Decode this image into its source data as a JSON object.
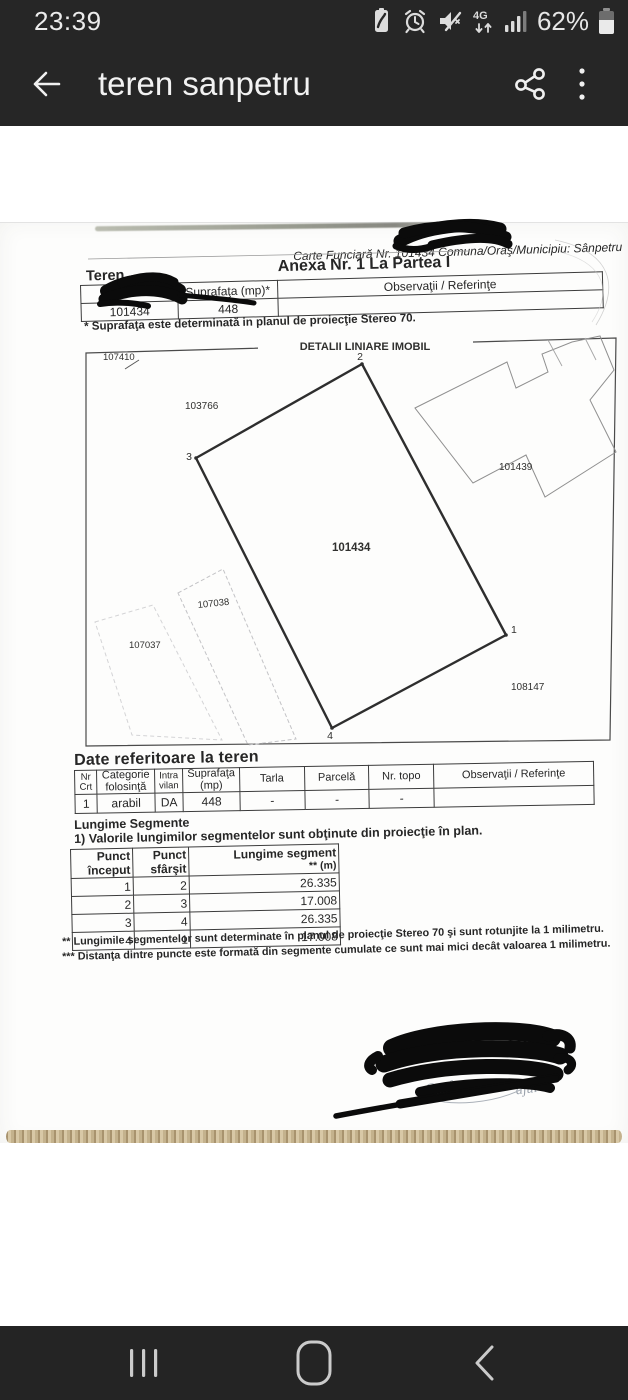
{
  "colors": {
    "system_bar_bg": "#262626",
    "nav_bar_bg": "#242424",
    "paper": "#fdfdfc",
    "marker_redaction": "#0b0b0b",
    "paper_edge_wood": "#d8c8a6"
  },
  "status_bar": {
    "time": "23:39",
    "network": "4G",
    "battery_percent": "62%",
    "icons": [
      "battery-saver-icon",
      "alarm-icon",
      "mute-icon",
      "mobile-data-4g-icon",
      "signal-strength-icon",
      "battery-icon"
    ]
  },
  "app_bar": {
    "title": "teren sanpetru"
  },
  "document": {
    "ref_line": "Carte Funciară Nr. 101434 Comuna/Oraş/Municipiu: Sânpetru",
    "anexa_title": "Anexa Nr. 1 La Partea I",
    "teren_heading": "Teren",
    "surface_table": {
      "headers": [
        "",
        "Suprafaţa (mp)*",
        "Observaţii / Referinţe"
      ],
      "row": [
        "101434",
        "448",
        ""
      ]
    },
    "surface_note": "* Suprafaţa este determinată in planul de proiecţie Stereo 70.",
    "plan": {
      "title": "DETALII LINIARE IMOBIL",
      "labels": {
        "top_left": "107410",
        "upper_left": "103766",
        "main": "101434",
        "right": "101439",
        "mid_left": "107038",
        "lower_left": "107037",
        "bottom_right": "108147"
      },
      "points": {
        "p1": "1",
        "p2": "2",
        "p3": "3",
        "p4": "4"
      }
    },
    "land_section": {
      "title": "Date referitoare la teren",
      "headers": [
        "Nr Crt",
        "Categorie folosinţă",
        "Intra vilan",
        "Suprafaţa (mp)",
        "Tarla",
        "Parcelă",
        "Nr. topo",
        "Observaţii / Referinţe"
      ],
      "row": [
        "1",
        "arabil",
        "DA",
        "448",
        "-",
        "-",
        "-",
        ""
      ]
    },
    "segments_section": {
      "title": "Lungime Segmente",
      "note": "1) Valorile lungimilor segmentelor sunt obţinute din proiecţie în plan.",
      "col_start": "Punct început",
      "col_end": "Punct sfârşit",
      "col_length": "Lungime segment",
      "col_length_unit": "** (m)",
      "rows": [
        [
          "1",
          "2",
          "26.335"
        ],
        [
          "2",
          "3",
          "17.008"
        ],
        [
          "3",
          "4",
          "26.335"
        ],
        [
          "4",
          "1",
          "17.008"
        ]
      ]
    },
    "footnote_2": "** Lungimile segmentelor sunt determinate în planul de proiecţie Stereo 70 şi sunt rotunjite la 1 milimetru.",
    "footnote_3": "*** Distanţa dintre puncte este formată din segmente cumulate ce sunt mai mici decât valoarea 1 milimetru.",
    "stamp_fragment_1": "Conform cu",
    "stamp_fragment_2": "ajul"
  }
}
